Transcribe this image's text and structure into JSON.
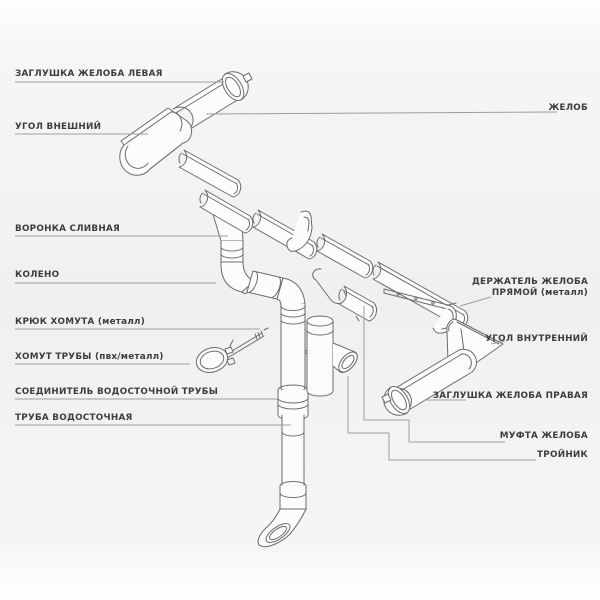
{
  "diagram": {
    "kind": "exploded technical line drawing of a rain gutter / downpipe system",
    "colors": {
      "background": "#f2f2f2",
      "part_outline": "#6b6b6b",
      "part_fill": "#fcfcfc",
      "leader_line": "#9e9e9e",
      "label_text": "#3d3d3d"
    }
  },
  "labels": {
    "left": [
      {
        "id": "zaglushka-zheloba-levaya",
        "text": "ЗАГЛУШКА ЖЕЛОБА ЛЕВАЯ"
      },
      {
        "id": "ugol-vneshniy",
        "text": "УГОЛ ВНЕШНИЙ"
      },
      {
        "id": "voronka-slivnaya",
        "text": "ВОРОНКА СЛИВНАЯ"
      },
      {
        "id": "koleno",
        "text": "КОЛЕНО"
      },
      {
        "id": "kryuk-khomuta",
        "text": "КРЮК ХОМУТА (металл)"
      },
      {
        "id": "khomut-truby",
        "text": "ХОМУТ ТРУБЫ (пвх/металл)"
      },
      {
        "id": "soedinitel-vodostochnoy-truby",
        "text": "СОЕДИНИТЕЛЬ ВОДОСТОЧНОЙ ТРУБЫ"
      },
      {
        "id": "truba-vodostochnaya",
        "text": "ТРУБА ВОДОСТОЧНАЯ"
      }
    ],
    "right": [
      {
        "id": "zhelob",
        "text": "ЖЕЛОБ"
      },
      {
        "id": "derzhatel-zheloba-pryamoy",
        "lines": [
          "ДЕРЖАТЕЛЬ ЖЕЛОБА",
          "ПРЯМОЙ (металл)"
        ]
      },
      {
        "id": "ugol-vnutrenniy",
        "text": "УГОЛ ВНУТРЕННИЙ"
      },
      {
        "id": "zaglushka-zheloba-pravaya",
        "text": "ЗАГЛУШКА ЖЕЛОБА ПРАВАЯ"
      },
      {
        "id": "mufta-zheloba",
        "text": "МУФТА ЖЕЛОБА"
      },
      {
        "id": "troynik",
        "text": "ТРОЙНИК"
      }
    ]
  }
}
